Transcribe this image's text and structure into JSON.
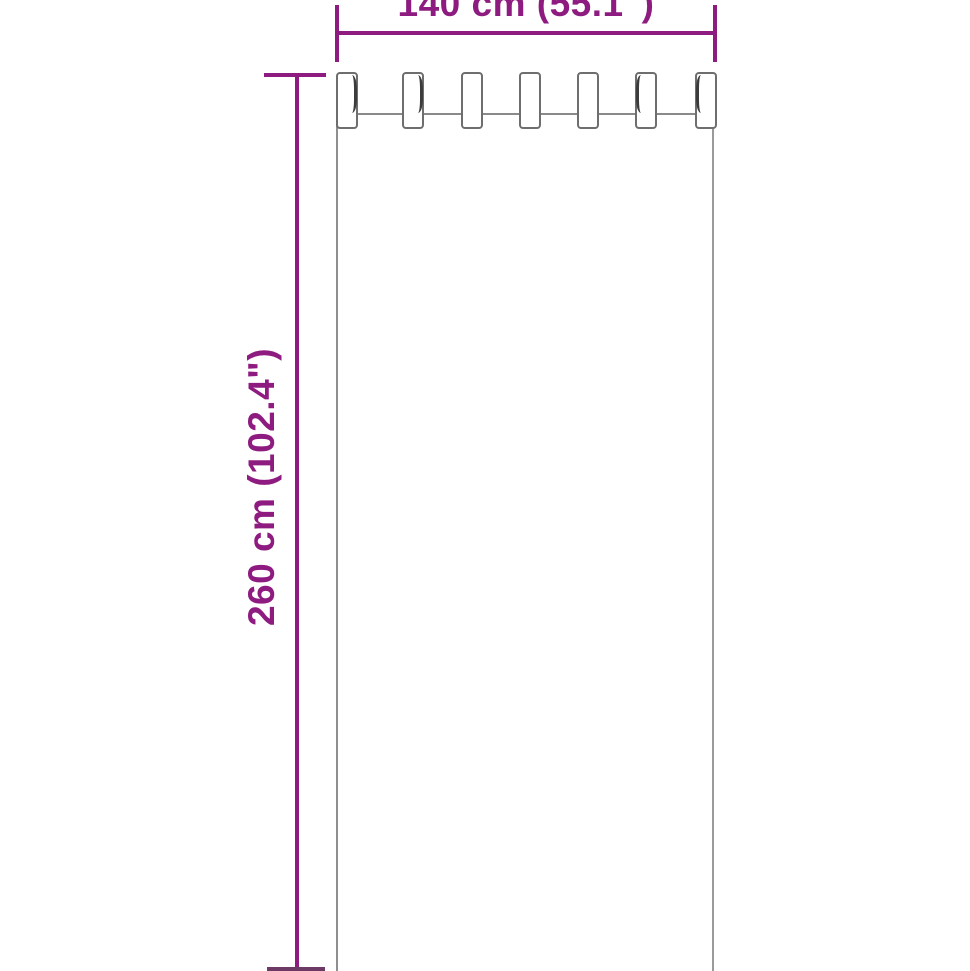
{
  "diagram": {
    "type": "product-dimension-diagram",
    "subject": "tab-top curtain front view with size arrows",
    "width_label": "140 cm (55.1\")",
    "height_label": "260 cm (102.4\")",
    "curtain": {
      "tab_count": 7
    },
    "colors": {
      "dimension_accent": "#8E1C80",
      "outline_gray": "#8a8a8a",
      "background": "#ffffff"
    }
  }
}
